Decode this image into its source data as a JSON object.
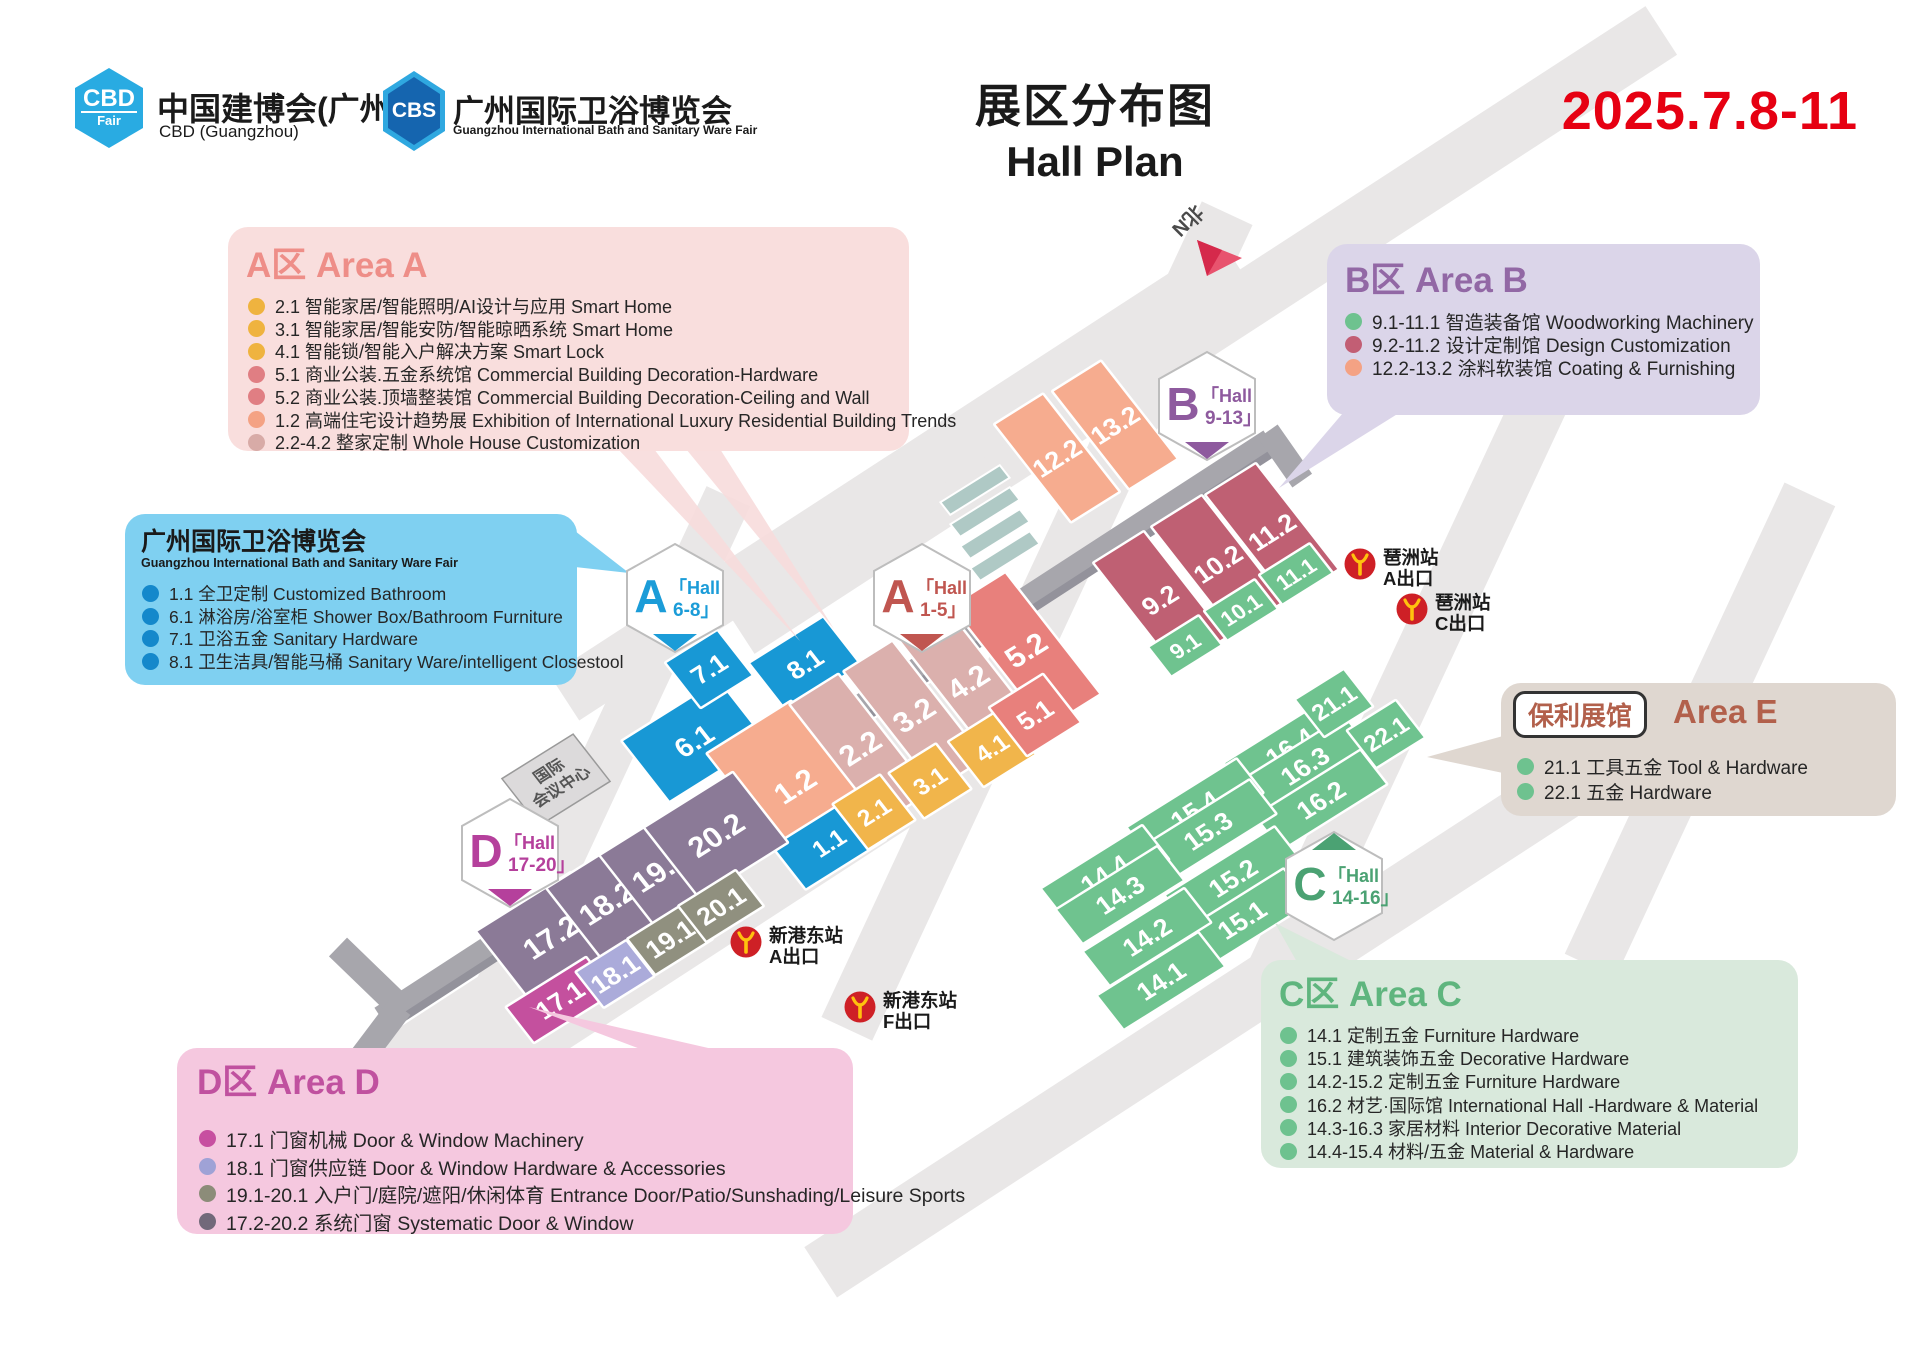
{
  "header": {
    "cbd_logo": {
      "top": "CBD",
      "bottom": "Fair"
    },
    "fair1": {
      "title": "中国建博会(广州)",
      "sub": "CBD (Guangzhou)"
    },
    "cbs_logo": "CBS",
    "fair2": {
      "title": "广州国际卫浴博览会",
      "sub": "Guangzhou International Bath and Sanitary Ware Fair"
    },
    "title": {
      "cn": "展区分布图",
      "en": "Hall Plan"
    },
    "date": "2025.7.8-11"
  },
  "legends": [
    {
      "id": "area-a",
      "title": "A区 Area A",
      "title_color": "#EE8E88",
      "bg": "#F9DEDD",
      "x": 228,
      "y": 227,
      "w": 681,
      "h": 224,
      "title_pos": {
        "x": 18,
        "y": 10,
        "size": 35
      },
      "rows": {
        "x": 20,
        "y0": 66,
        "step": 22.7,
        "size": 18
      },
      "items": [
        {
          "c": "#EFB33F",
          "t": "2.1 智能家居/智能照明/AI设计与应用 Smart Home"
        },
        {
          "c": "#EFB33F",
          "t": "3.1 智能家居/智能安防/智能晾晒系统 Smart Home"
        },
        {
          "c": "#EFB33F",
          "t": "4.1 智能锁/智能入户解决方案 Smart Lock"
        },
        {
          "c": "#E07E83",
          "t": "5.1 商业公装.五金系统馆 Commercial Building Decoration-Hardware"
        },
        {
          "c": "#E07E83",
          "t": "5.2 商业公装.顶墙整装馆 Commercial Building Decoration-Ceiling and Wall"
        },
        {
          "c": "#F4A284",
          "t": "1.2 高端住宅设计趋势展 Exhibition of International Luxury Residential Building Trends"
        },
        {
          "c": "#D8ABA7",
          "t": "2.2-4.2 整家定制 Whole House Customization"
        }
      ]
    },
    {
      "id": "bath-fair",
      "title": "广州国际卫浴博览会",
      "title_color": "#1A1A1A",
      "bg": "#7FD0F1",
      "x": 125,
      "y": 514,
      "w": 452,
      "h": 171,
      "title_pos": {
        "x": 16,
        "y": 8,
        "size": 25
      },
      "subtitle": {
        "t": "Guangzhou International Bath and Sanitary Ware Fair",
        "x": 16,
        "y": 42,
        "size": 12.5
      },
      "rows": {
        "x": 17,
        "y0": 67,
        "step": 22.7,
        "size": 17.5
      },
      "items": [
        {
          "c": "#1488CB",
          "t": "1.1 全卫定制 Customized Bathroom"
        },
        {
          "c": "#1488CB",
          "t": "6.1 淋浴房/浴室柜 Shower Box/Bathroom Furniture"
        },
        {
          "c": "#1488CB",
          "t": "7.1 卫浴五金 Sanitary Hardware"
        },
        {
          "c": "#1488CB",
          "t": "8.1 卫生洁具/智能马桶 Sanitary Ware/intelligent Closestool"
        }
      ]
    },
    {
      "id": "area-b",
      "title": "B区 Area B",
      "title_color": "#9268A5",
      "bg": "#DBD5E9",
      "x": 1327,
      "y": 244,
      "w": 433,
      "h": 171,
      "title_pos": {
        "x": 18,
        "y": 8,
        "size": 35
      },
      "rows": {
        "x": 18,
        "y0": 64,
        "step": 23.2,
        "size": 19
      },
      "items": [
        {
          "c": "#6EC28F",
          "t": "9.1-11.1 智造装备馆 Woodworking Machinery"
        },
        {
          "c": "#C25E74",
          "t": "9.2-11.2 设计定制馆 Design Customization"
        },
        {
          "c": "#F4A284",
          "t": "12.2-13.2 涂料软装馆 Coating & Furnishing"
        }
      ]
    },
    {
      "id": "area-e",
      "title": "Area E",
      "title_color": "#B2604B",
      "bg": "#DFD7D0",
      "x": 1501,
      "y": 683,
      "w": 395,
      "h": 133,
      "badge": {
        "t": "保利展馆",
        "x": 12,
        "y": 8,
        "size": 26
      },
      "title_pos": {
        "x": 172,
        "y": 10,
        "size": 33
      },
      "rows": {
        "x": 16,
        "y0": 70,
        "step": 25,
        "size": 19
      },
      "items": [
        {
          "c": "#6EC28F",
          "t": "21.1 工具五金 Tool & Hardware"
        },
        {
          "c": "#6EC28F",
          "t": "22.1 五金 Hardware"
        }
      ]
    },
    {
      "id": "area-c",
      "title": "C区 Area C",
      "title_color": "#5FB57E",
      "bg": "#D9E9DC",
      "x": 1261,
      "y": 960,
      "w": 537,
      "h": 208,
      "title_pos": {
        "x": 18,
        "y": 6,
        "size": 35
      },
      "rows": {
        "x": 19,
        "y0": 62,
        "step": 23.2,
        "size": 18
      },
      "items": [
        {
          "c": "#6EC28F",
          "t": "14.1 定制五金 Furniture Hardware"
        },
        {
          "c": "#6EC28F",
          "t": "15.1 建筑装饰五金 Decorative Hardware"
        },
        {
          "c": "#6EC28F",
          "t": "14.2-15.2 定制五金 Furniture Hardware"
        },
        {
          "c": "#6EC28F",
          "t": "16.2 材艺·国际馆 International Hall -Hardware & Material"
        },
        {
          "c": "#6EC28F",
          "t": "14.3-16.3 家居材料 Interior Decorative Material"
        },
        {
          "c": "#6EC28F",
          "t": "14.4-15.4 材料/五金 Material & Hardware"
        }
      ]
    },
    {
      "id": "area-d",
      "title": "D区 Area D",
      "title_color": "#C0519F",
      "bg": "#F5C8DF",
      "x": 177,
      "y": 1048,
      "w": 676,
      "h": 186,
      "title_pos": {
        "x": 20,
        "y": 6,
        "size": 35
      },
      "rows": {
        "x": 22,
        "y0": 76,
        "step": 27.5,
        "size": 19.5
      },
      "items": [
        {
          "c": "#C74FA0",
          "t": "17.1 门窗机械  Door & Window Machinery"
        },
        {
          "c": "#9FA2D6",
          "t": "18.1 门窗供应链  Door & Window Hardware & Accessories"
        },
        {
          "c": "#8C8C79",
          "t": "19.1-20.1 入户门/庭院/遮阳/休闲体育 Entrance Door/Patio/Sunshading/Leisure Sports"
        },
        {
          "c": "#72697A",
          "t": "17.2-20.2 系统门窗 Systematic Door & Window"
        }
      ]
    }
  ],
  "map": {
    "north_label": "北N",
    "convention": {
      "l1": "国际",
      "l2": "会议中心"
    },
    "badges": [
      {
        "letter": "A",
        "word": "「Hall",
        "range": "6-8」",
        "color": "#1B9CD8",
        "cx": 675,
        "cy": 598,
        "notch": "bottom"
      },
      {
        "letter": "A",
        "word": "「Hall",
        "range": "1-5」",
        "color": "#C05650",
        "cx": 922,
        "cy": 598,
        "notch": "bottom"
      },
      {
        "letter": "B",
        "word": "「Hall",
        "range": "9-13」",
        "color": "#8E5A9E",
        "cx": 1207,
        "cy": 406,
        "notch": "bottom"
      },
      {
        "letter": "C",
        "word": "「Hall",
        "range": "14-16」",
        "color": "#4BA273",
        "cx": 1334,
        "cy": 886,
        "notch": "top"
      },
      {
        "letter": "D",
        "word": "「Hall",
        "range": "17-20」",
        "color": "#B5409C",
        "cx": 510,
        "cy": 853,
        "notch": "bottom"
      }
    ],
    "halls": [
      {
        "label": "6.1",
        "color": "#1898D5",
        "cx": 694,
        "cy": 741,
        "p": 115,
        "q": 78,
        "fs": 28
      },
      {
        "label": "7.1",
        "color": "#1898D5",
        "cx": 709,
        "cy": 669,
        "p": 62,
        "q": 58,
        "fs": 26
      },
      {
        "label": "8.1",
        "color": "#1898D5",
        "cx": 805,
        "cy": 664,
        "p": 88,
        "q": 62,
        "fs": 26
      },
      {
        "label": "12.2",
        "color": "#F6AC8F",
        "cx": 1057,
        "cy": 458,
        "p": 58,
        "q": 125,
        "fs": 26
      },
      {
        "label": "13.2",
        "color": "#F6AC8F",
        "cx": 1115,
        "cy": 425,
        "p": 58,
        "q": 125,
        "fs": 26
      },
      {
        "label": "1.2",
        "color": "#F6AC8F",
        "cx": 795,
        "cy": 786,
        "p": 100,
        "q": 150,
        "fs": 30
      },
      {
        "label": "1.1",
        "color": "#1898D5",
        "cx": 829,
        "cy": 843,
        "p": 95,
        "q": 55,
        "fs": 24
      },
      {
        "label": "2.2",
        "color": "#DBB0AD",
        "cx": 860,
        "cy": 748,
        "p": 58,
        "q": 150,
        "fs": 30
      },
      {
        "label": "3.2",
        "color": "#DBB0AD",
        "cx": 914,
        "cy": 715,
        "p": 58,
        "q": 150,
        "fs": 30
      },
      {
        "label": "4.2",
        "color": "#DBB0AD",
        "cx": 968,
        "cy": 682,
        "p": 58,
        "q": 150,
        "fs": 30
      },
      {
        "label": "5.2",
        "color": "#E8807C",
        "cx": 1026,
        "cy": 650,
        "p": 64,
        "q": 155,
        "fs": 30
      },
      {
        "label": "2.1",
        "color": "#F1B54B",
        "cx": 874,
        "cy": 812,
        "p": 56,
        "q": 58,
        "fs": 24
      },
      {
        "label": "3.1",
        "color": "#F1B54B",
        "cx": 930,
        "cy": 781,
        "p": 56,
        "q": 58,
        "fs": 24
      },
      {
        "label": "4.1",
        "color": "#F1B54B",
        "cx": 992,
        "cy": 748,
        "p": 62,
        "q": 58,
        "fs": 24
      },
      {
        "label": "5.1",
        "color": "#E8807C",
        "cx": 1035,
        "cy": 715,
        "p": 64,
        "q": 62,
        "fs": 26
      },
      {
        "label": "9.2",
        "color": "#BF6073",
        "cx": 1160,
        "cy": 600,
        "p": 60,
        "q": 135,
        "fs": 26
      },
      {
        "label": "10.2",
        "color": "#BF6073",
        "cx": 1218,
        "cy": 564,
        "p": 60,
        "q": 135,
        "fs": 26
      },
      {
        "label": "11.2",
        "color": "#BF6073",
        "cx": 1272,
        "cy": 532,
        "p": 60,
        "q": 135,
        "fs": 26
      },
      {
        "label": "9.1",
        "color": "#6FC38F",
        "cx": 1185,
        "cy": 646,
        "p": 60,
        "q": 38,
        "fs": 22
      },
      {
        "label": "10.1",
        "color": "#6FC38F",
        "cx": 1241,
        "cy": 610,
        "p": 60,
        "q": 38,
        "fs": 22
      },
      {
        "label": "11.1",
        "color": "#6FC38F",
        "cx": 1296,
        "cy": 574,
        "p": 60,
        "q": 38,
        "fs": 22
      },
      {
        "label": "16.4",
        "color": "#6FC38F",
        "cx": 1290,
        "cy": 747,
        "p": 125,
        "q": 44,
        "fs": 26
      },
      {
        "label": "16.3",
        "color": "#6FC38F",
        "cx": 1305,
        "cy": 766,
        "p": 125,
        "q": 44,
        "fs": 26
      },
      {
        "label": "16.2",
        "color": "#6FC38F",
        "cx": 1321,
        "cy": 800,
        "p": 125,
        "q": 44,
        "fs": 26
      },
      {
        "label": "15.4",
        "color": "#6FC38F",
        "cx": 1195,
        "cy": 810,
        "p": 130,
        "q": 44,
        "fs": 26
      },
      {
        "label": "15.3",
        "color": "#6FC38F",
        "cx": 1208,
        "cy": 831,
        "p": 130,
        "q": 44,
        "fs": 26
      },
      {
        "label": "15.2",
        "color": "#6FC38F",
        "cx": 1233,
        "cy": 878,
        "p": 130,
        "q": 44,
        "fs": 26
      },
      {
        "label": "15.1",
        "color": "#6FC38F",
        "cx": 1242,
        "cy": 920,
        "p": 130,
        "q": 44,
        "fs": 26
      },
      {
        "label": "14.4",
        "color": "#6FC38F",
        "cx": 1105,
        "cy": 874,
        "p": 120,
        "q": 44,
        "fs": 26
      },
      {
        "label": "14.3",
        "color": "#6FC38F",
        "cx": 1120,
        "cy": 895,
        "p": 120,
        "q": 44,
        "fs": 26
      },
      {
        "label": "14.2",
        "color": "#6FC38F",
        "cx": 1147,
        "cy": 937,
        "p": 120,
        "q": 44,
        "fs": 26
      },
      {
        "label": "14.1",
        "color": "#6FC38F",
        "cx": 1161,
        "cy": 981,
        "p": 120,
        "q": 44,
        "fs": 26
      },
      {
        "label": "21.1",
        "color": "#6FC38F",
        "cx": 1334,
        "cy": 703,
        "p": 58,
        "q": 48,
        "fs": 24
      },
      {
        "label": "22.1",
        "color": "#6FC38F",
        "cx": 1386,
        "cy": 734,
        "p": 58,
        "q": 48,
        "fs": 24
      },
      {
        "label": "17.2",
        "color": "#8B7A97",
        "cx": 551,
        "cy": 937,
        "p": 112,
        "q": 90,
        "fs": 30
      },
      {
        "label": "18.2",
        "color": "#8B7A97",
        "cx": 607,
        "cy": 903,
        "p": 78,
        "q": 90,
        "fs": 30
      },
      {
        "label": "19.2",
        "color": "#8B7A97",
        "cx": 660,
        "cy": 870,
        "p": 78,
        "q": 90,
        "fs": 30
      },
      {
        "label": "20.2",
        "color": "#8B7A97",
        "cx": 716,
        "cy": 835,
        "p": 105,
        "q": 90,
        "fs": 30
      },
      {
        "label": "17.1",
        "color": "#C4509E",
        "cx": 560,
        "cy": 1000,
        "p": 95,
        "q": 46,
        "fs": 26
      },
      {
        "label": "18.1",
        "color": "#ABABDA",
        "cx": 615,
        "cy": 974,
        "p": 60,
        "q": 46,
        "fs": 26
      },
      {
        "label": "19.1",
        "color": "#90907F",
        "cx": 670,
        "cy": 939,
        "p": 68,
        "q": 46,
        "fs": 26
      },
      {
        "label": "20.1",
        "color": "#90907F",
        "cx": 721,
        "cy": 906,
        "p": 68,
        "q": 46,
        "fs": 26
      }
    ],
    "metros": [
      {
        "station": "琶洲站",
        "exit": "A出口",
        "x": 1360,
        "y": 564
      },
      {
        "station": "琶洲站",
        "exit": "C出口",
        "x": 1412,
        "y": 609
      },
      {
        "station": "新港东站",
        "exit": "A出口",
        "x": 746,
        "y": 942
      },
      {
        "station": "新港东站",
        "exit": "F出口",
        "x": 860,
        "y": 1007
      }
    ]
  }
}
